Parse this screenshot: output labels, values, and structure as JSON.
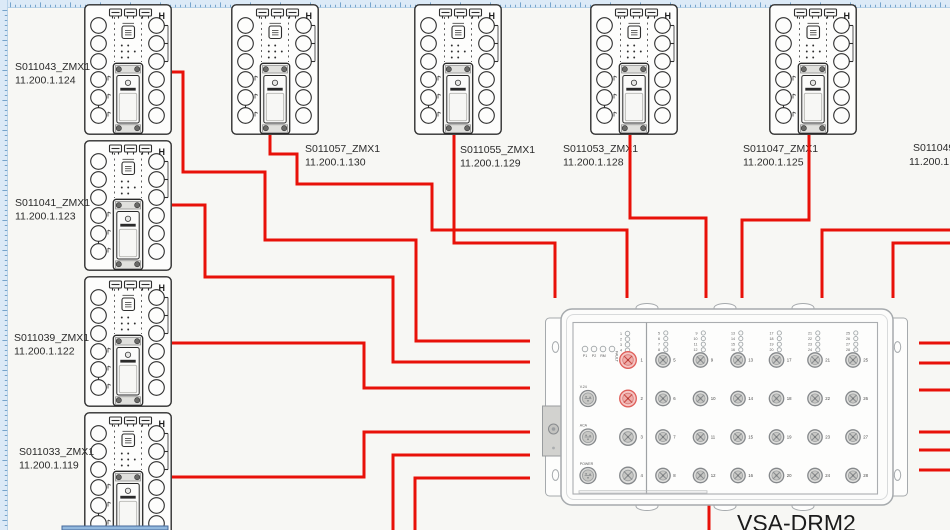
{
  "app": {
    "background": "#f7f7f4",
    "ruler_color": "#dceaf7",
    "ruler_tick_color": "#4a86b8",
    "wire_color": "#e81109",
    "highlight_color": "#df5f5a"
  },
  "module": {
    "corner_label": "H"
  },
  "devices": {
    "left_column": [
      {
        "name": "S011043_ZMX1",
        "ip": "11.200.1.124"
      },
      {
        "name": "S011041_ZMX1",
        "ip": "11.200.1.123"
      },
      {
        "name": "S011039_ZMX1",
        "ip": "11.200.1.122"
      },
      {
        "name": "S011033_ZMX1",
        "ip": "11.200.1.119"
      }
    ],
    "top_row": [
      {
        "name": "S011057_ZMX1",
        "ip": "11.200.1.130"
      },
      {
        "name": "S011055_ZMX1",
        "ip": "11.200.1.129"
      },
      {
        "name": "S011053_ZMX1",
        "ip": "11.200.1.128"
      },
      {
        "name": "S011047_ZMX1",
        "ip": "11.200.1.125"
      }
    ],
    "right_partial": {
      "name": "S011049",
      "ip": "11.200.1"
    }
  },
  "drm": {
    "title": "VSA-DRM2",
    "status_leds": [
      "P1",
      "P2",
      "RM",
      "FAULT"
    ],
    "left_led_numbers": [
      1,
      2,
      3,
      4
    ],
    "left_ports": [
      {
        "number": 1,
        "highlighted": true
      },
      {
        "number": 2,
        "highlighted": true
      },
      {
        "number": 3,
        "highlighted": false
      },
      {
        "number": 4,
        "highlighted": false
      }
    ],
    "aux_ports": [
      "V.24",
      "ACA",
      "POWER"
    ],
    "right_port_columns": [
      [
        5,
        6,
        7,
        8
      ],
      [
        9,
        10,
        11,
        12
      ],
      [
        13,
        14,
        15,
        16
      ],
      [
        17,
        18,
        19,
        20
      ],
      [
        21,
        22,
        23,
        24
      ],
      [
        25,
        26,
        27,
        28
      ]
    ]
  }
}
